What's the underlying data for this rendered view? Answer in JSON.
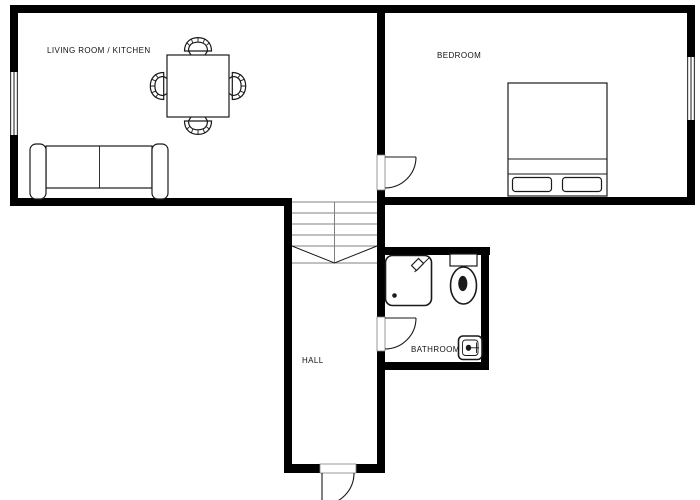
{
  "page": {
    "type": "apartment-floor-plan"
  },
  "colors": {
    "wall": "#000000",
    "line": "#1a1a1a",
    "stair": "#808080",
    "text": "#111111",
    "background": "#ffffff"
  },
  "rooms": {
    "living_room_kitchen": {
      "label": "LIVING ROOM / KITCHEN",
      "furniture": [
        "sofa",
        "dining-table",
        "dining-chair",
        "dining-chair",
        "dining-chair",
        "dining-chair"
      ],
      "features": [
        "window"
      ]
    },
    "bedroom": {
      "label": "BEDROOM",
      "furniture": [
        "double-bed",
        "pillow",
        "pillow"
      ],
      "features": [
        "window",
        "door"
      ]
    },
    "hall": {
      "label": "HALL",
      "features": [
        "staircase",
        "entrance-door"
      ]
    },
    "bathroom": {
      "label": "BATHROOM",
      "furniture": [
        "shower",
        "toilet",
        "sink"
      ],
      "features": [
        "door"
      ]
    }
  }
}
